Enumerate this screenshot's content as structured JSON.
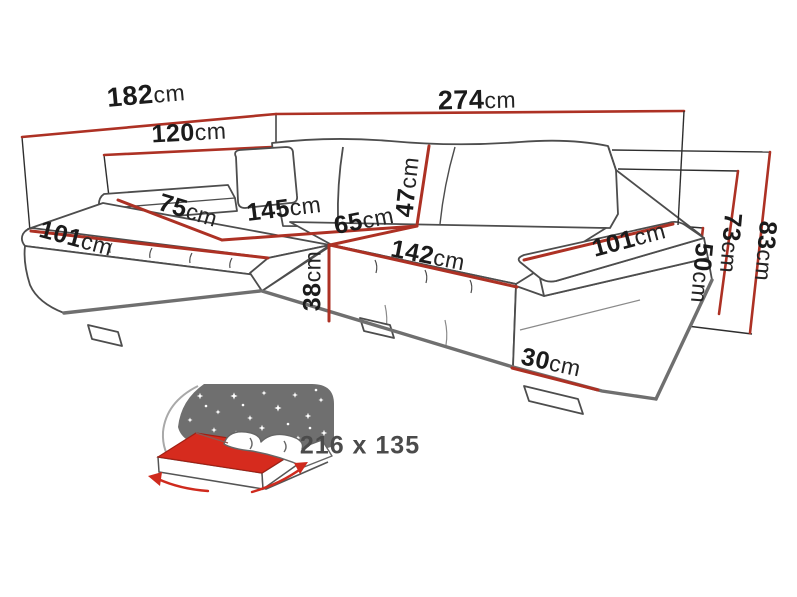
{
  "diagram_title": "corner-sofa-dimensions",
  "unit": "cm",
  "dimensions": [
    {
      "name": "left-side-total-length",
      "value": "182",
      "unit": "cm"
    },
    {
      "name": "chaise-back-width",
      "value": "120",
      "unit": "cm"
    },
    {
      "name": "total-width",
      "value": "274",
      "unit": "cm"
    },
    {
      "name": "chaise-arm-depth",
      "value": "101",
      "unit": "cm"
    },
    {
      "name": "chaise-seat-width",
      "value": "75",
      "unit": "cm"
    },
    {
      "name": "chaise-seat-length",
      "value": "145",
      "unit": "cm"
    },
    {
      "name": "seat-depth",
      "value": "65",
      "unit": "cm"
    },
    {
      "name": "backrest-cushion-height",
      "value": "47",
      "unit": "cm"
    },
    {
      "name": "seat-front-width",
      "value": "142",
      "unit": "cm"
    },
    {
      "name": "seat-height",
      "value": "38",
      "unit": "cm"
    },
    {
      "name": "arm-depth",
      "value": "101",
      "unit": "cm"
    },
    {
      "name": "arm-width",
      "value": "30",
      "unit": "cm"
    },
    {
      "name": "armrest-height",
      "value": "50",
      "unit": "cm"
    },
    {
      "name": "back-height-mid",
      "value": "73",
      "unit": "cm"
    },
    {
      "name": "total-height",
      "value": "83",
      "unit": "cm"
    }
  ],
  "sleeping_area": {
    "value": "216 x 135"
  },
  "icons": {
    "sleeping_area": "bed-with-starry-night-icon"
  },
  "colors": {
    "dimension_line": "#ad3124",
    "frame_line": "#2e2e2e",
    "sofa_outline": "#4d4d4d",
    "mattress_red": "#d62b1e",
    "night_panel_gray": "#6f6f6f",
    "label_text": "#1b1b1b",
    "sleeping_text": "#4b4b4b"
  }
}
